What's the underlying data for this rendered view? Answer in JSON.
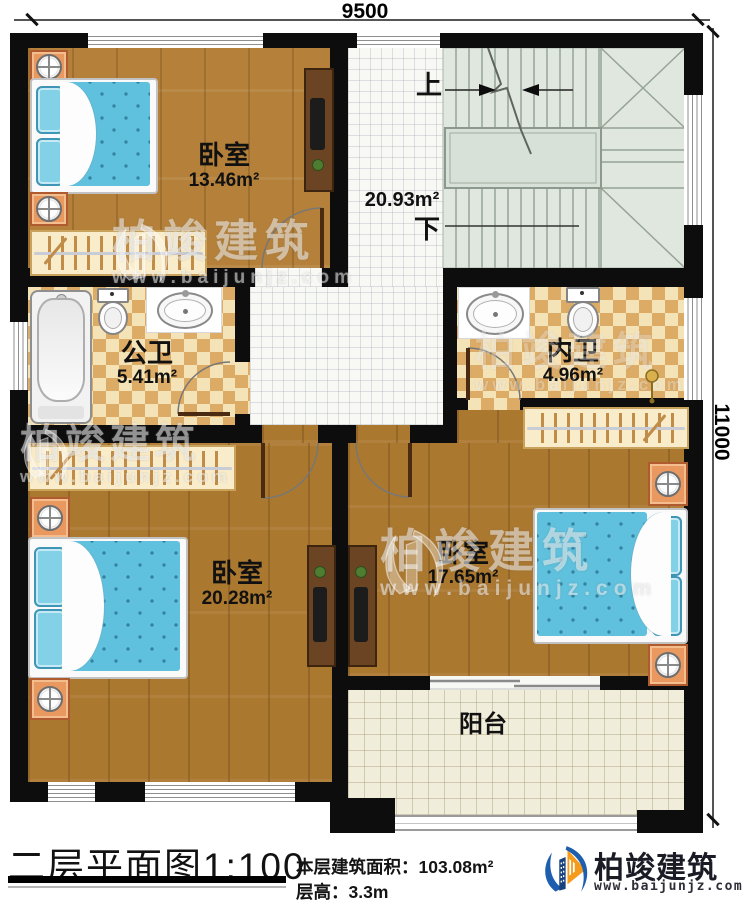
{
  "dimensions": {
    "width_label": "9500",
    "height_label": "11000"
  },
  "stairs": {
    "up": "上",
    "down": "下"
  },
  "rooms": {
    "bedroom1": {
      "name": "卧室",
      "area": "13.46m²"
    },
    "hallway": {
      "area": "20.93m²"
    },
    "public_bath": {
      "name": "公卫",
      "area": "5.41m²"
    },
    "ensuite_bath": {
      "name": "内卫",
      "area": "4.96m²"
    },
    "bedroom2": {
      "name": "卧室",
      "area": "20.28m²"
    },
    "bedroom3": {
      "name": "卧室",
      "area": "17.65m²"
    },
    "balcony": {
      "name": "阳台"
    }
  },
  "footer": {
    "title": "二层平面图",
    "scale": "1:100",
    "area_label": "本层建筑面积：",
    "area_value": "103.08m²",
    "floor_height_label": "层高：",
    "floor_height_value": "3.3m"
  },
  "brand": {
    "name": "柏竣建筑",
    "url": "www.baijunjz.com",
    "logo_icon": "sail-building-logo"
  },
  "colors": {
    "wall": "#0d0d0d",
    "wood_floor": "#b5813a",
    "tile_light": "#f5e3b8",
    "tile_dark": "#dcab66",
    "stair_fill": "#e0e7df",
    "bed_blue": "#5fc1dd",
    "brand_blue": "#1d5fae",
    "brand_orange": "#f59b1c"
  }
}
